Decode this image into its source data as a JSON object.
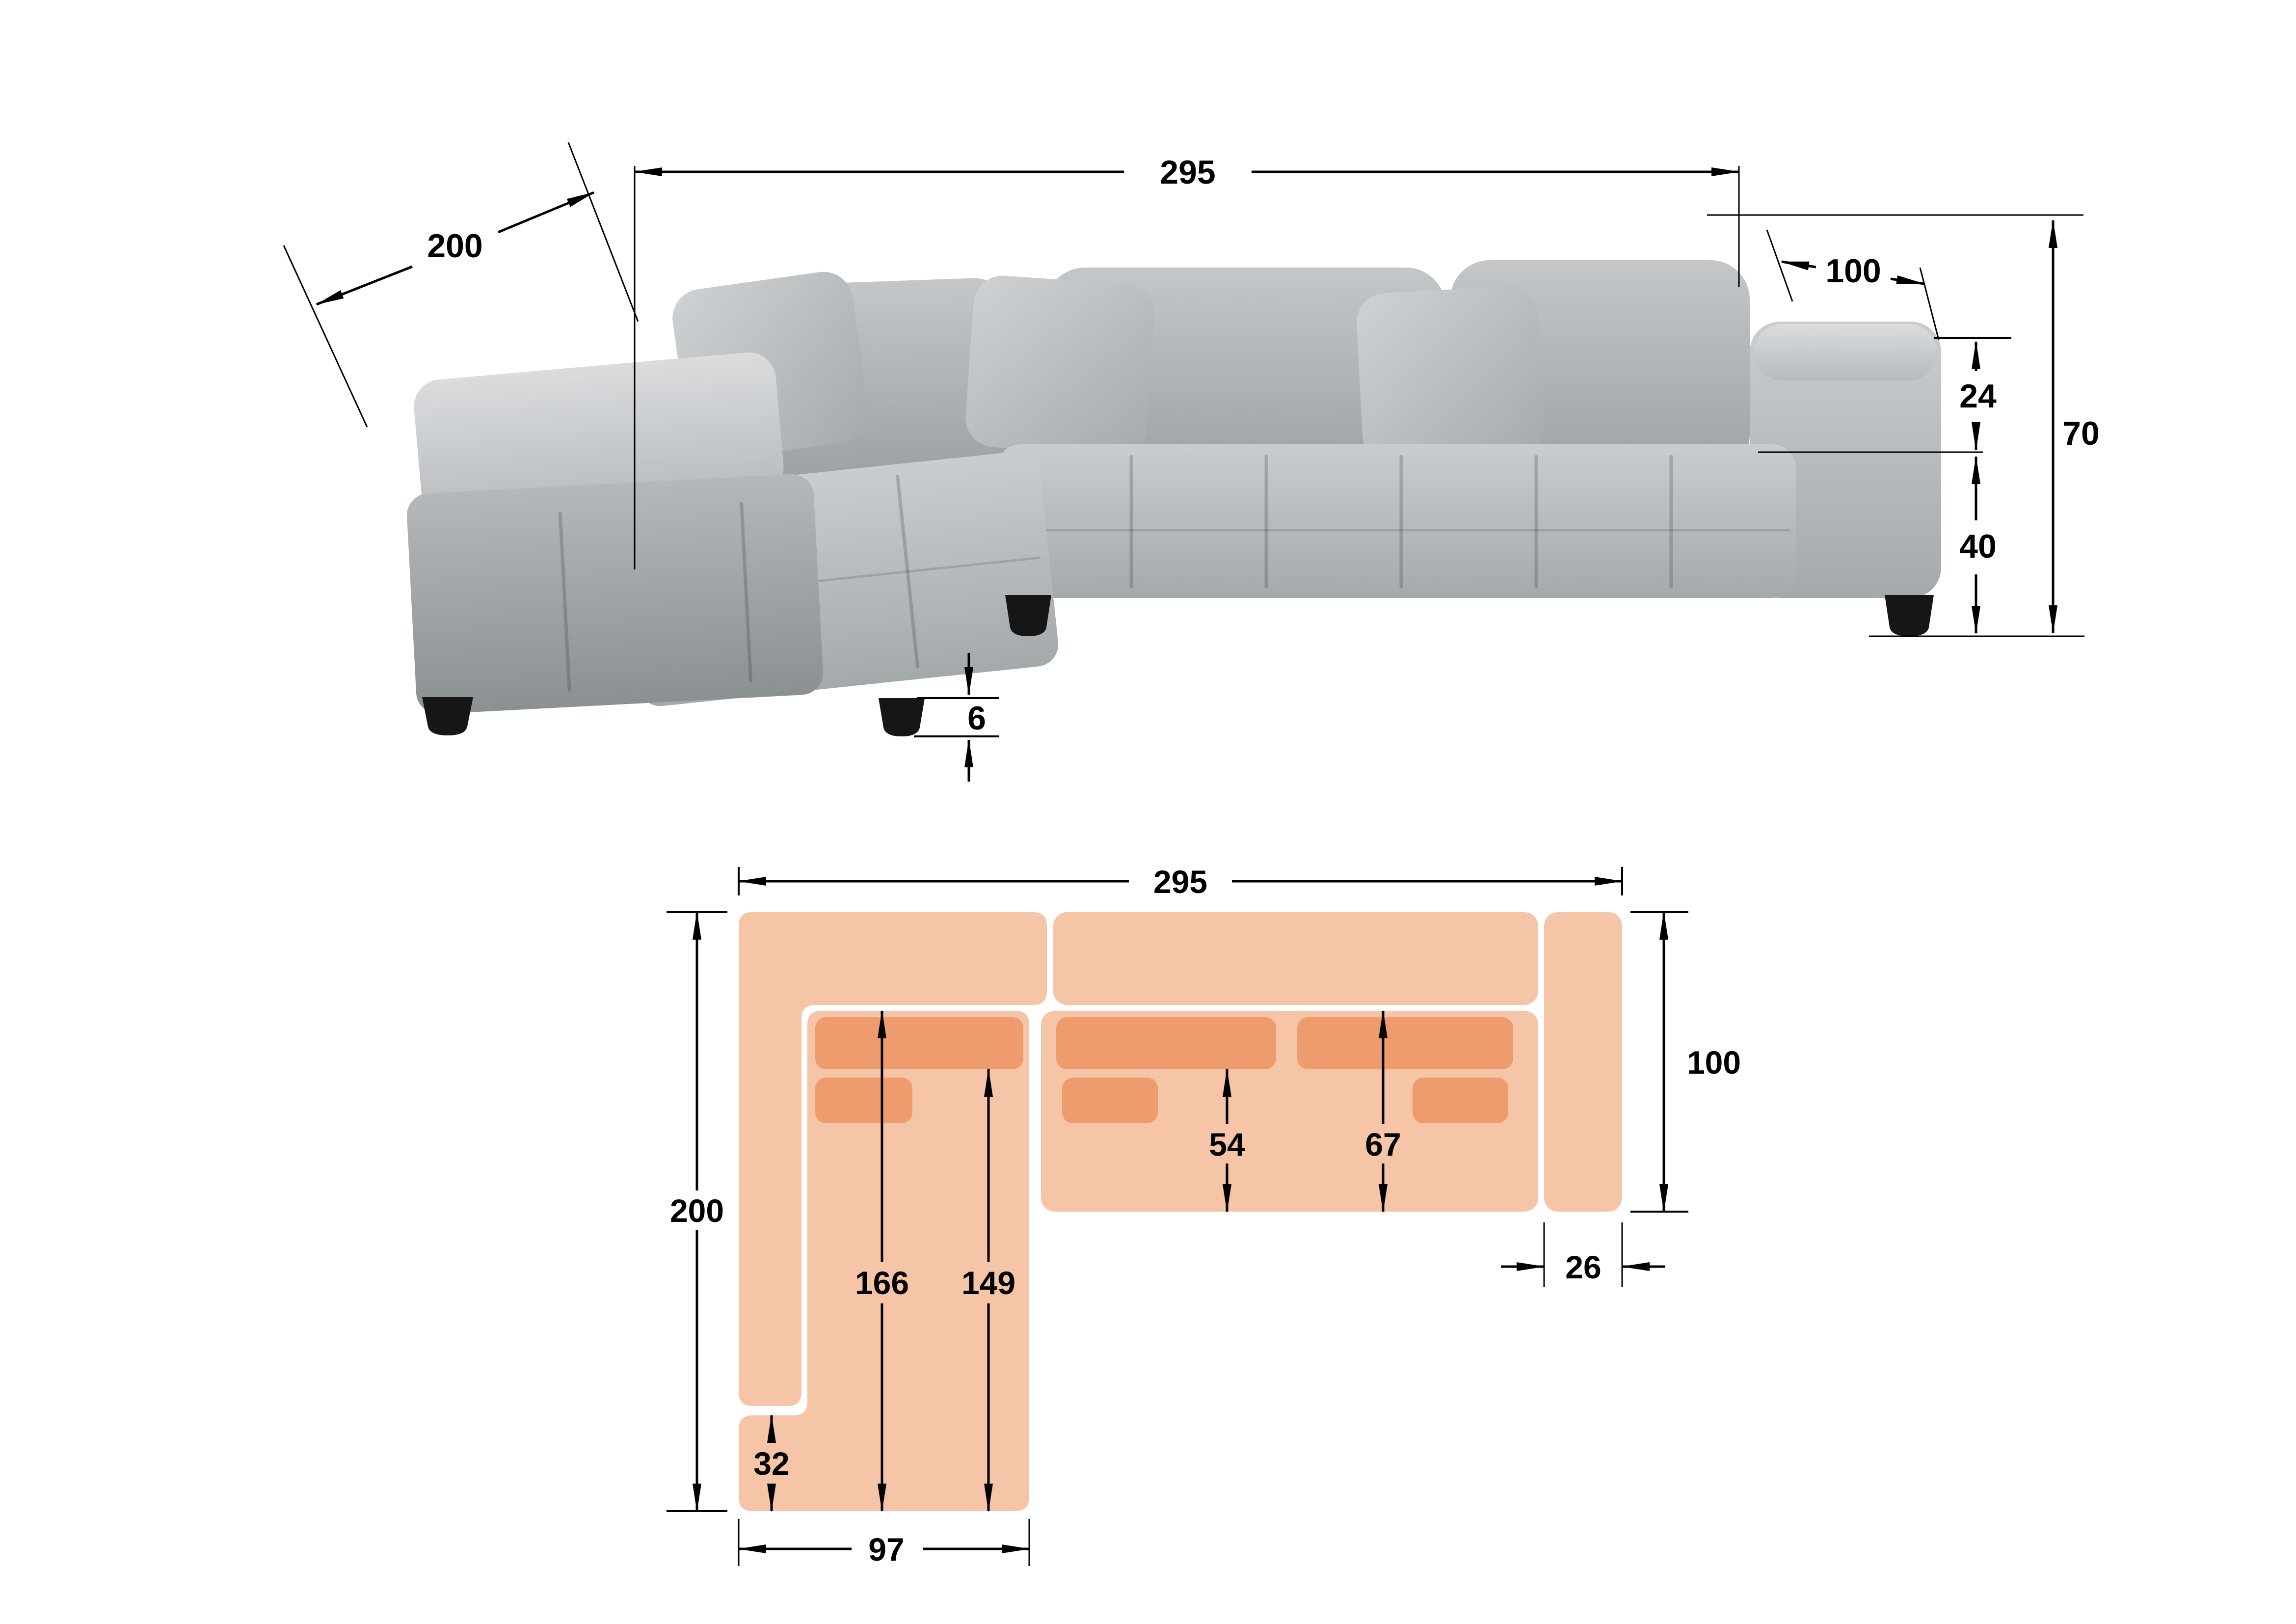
{
  "page": {
    "background": "#ffffff",
    "description": "corner sofa dimension diagram with front view photo and top view plan"
  },
  "photo_figure": {
    "labels": {
      "overall_width": "295",
      "chaise_depth": "200",
      "armrest_depth": "100",
      "backrest_above_seat": "24",
      "overall_height": "70",
      "seat_height": "40",
      "leg_height": "6"
    }
  },
  "plan_figure": {
    "labels": {
      "overall_width": "295",
      "total_depth": "200",
      "right_side_depth": "100",
      "seat_depth_front": "54",
      "seat_depth_total": "67",
      "chaise_inner_length": "166",
      "chaise_usable_length": "149",
      "chaise_front_section": "32",
      "chaise_width": "97",
      "armrest_width": "26"
    }
  },
  "colors": {
    "plan_body": "#F6C5A7",
    "plan_cushion": "#EE9C6E",
    "sofa_fabric": "#b3b8ba",
    "sofa_fabric_light": "#d4d7d9",
    "sofa_fabric_dark": "#8f9497",
    "legs": "#161616",
    "dimension_lines": "#000000"
  }
}
